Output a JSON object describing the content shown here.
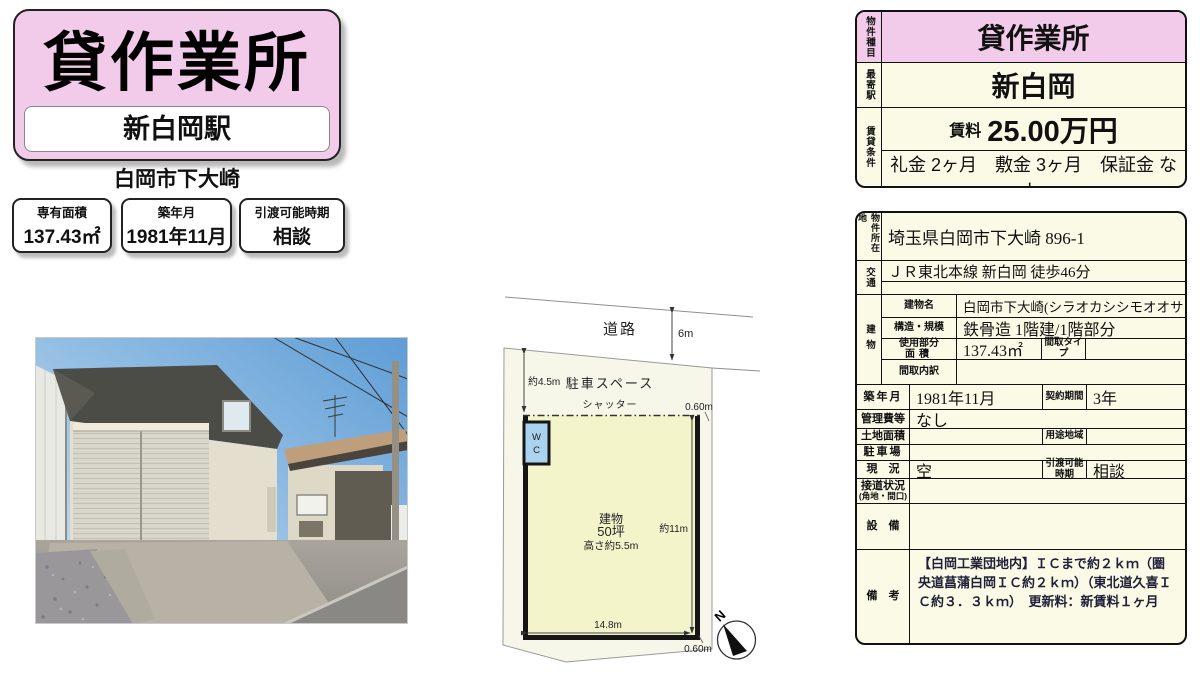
{
  "colors": {
    "pink": "#f3cbea",
    "cream": "#fafae6",
    "plan_parcel": "#f7f7e9",
    "plan_yellow": "#f4f4cb",
    "wc_blue": "#a9d3ef"
  },
  "header": {
    "title": "貸作業所",
    "station": "新白岡駅",
    "city": "白岡市下大崎",
    "badges": [
      {
        "label": "専有面積",
        "value": "137.43㎡"
      },
      {
        "label": "築年月",
        "value": "1981年11月"
      },
      {
        "label": "引渡可能時期",
        "value": "相談"
      }
    ]
  },
  "summary": {
    "type_label": "物件種目",
    "type_value": "貸作業所",
    "station_label": "最寄駅",
    "station_value": "新白岡",
    "terms_label": "賃貸条件",
    "rent_label": "賃料",
    "rent_value": "25.00万円",
    "terms_value": "礼金 2ヶ月　敷金 3ヶ月　保証金 なし"
  },
  "detail": {
    "address_label": "物件所在地",
    "address": "埼玉県白岡市下大崎 896-1",
    "access_label": "交通",
    "access": "ＪＲ東北本線 新白岡 徒歩46分",
    "building_label": "建物",
    "building_name_label": "建物名",
    "building_name": "白岡市下大崎(シラオカシシモオオサキ)",
    "structure_label": "構造・規模",
    "structure": "鉄骨造 1階建/1階部分",
    "area_label_1": "使用部分",
    "area_label_2": "面積",
    "area": "137.43㎡",
    "layout_type_label": "間取タイプ",
    "layout_type": "",
    "layout_detail_label": "間取内訳",
    "layout_detail": "",
    "built_label": "築年月",
    "built": "1981年11月",
    "contract_label": "契約期間",
    "contract": "3年",
    "management_label": "管理費等",
    "management": "なし",
    "land_label": "土地面積",
    "land": "",
    "zoning_label": "用途地域",
    "zoning": "",
    "parking_label": "駐車場",
    "parking": "",
    "status_label": "現　況",
    "status": "空",
    "handover_label_1": "引渡可能",
    "handover_label_2": "時期",
    "handover": "相談",
    "road_label_1": "接道状況",
    "road_label_2": "(角地・間口)",
    "road_value": "",
    "equipment_label": "設　備",
    "equipment": "",
    "remarks_label": "備　考",
    "remarks": "【白岡工業団地内】ＩＣまで約２ｋｍ（圏央道菖蒲白岡ＩＣ約２ｋｍ）（東北道久喜ＩＣ約３．３ｋｍ）　更新料：新賃料１ヶ月"
  },
  "plan": {
    "road": "道路",
    "road_width": "6m",
    "parking": "駐車スペース",
    "parking_depth": "約4.5m",
    "shutter": "シャッター",
    "gap_top": "0.60m",
    "gap_bottom": "0.60m",
    "building_line1": "建物",
    "building_line2": "50坪",
    "building_line3": "高さ約5.5m",
    "side_length": "約11m",
    "front_length": "14.8m",
    "wc_line1": "W",
    "wc_line2": "C",
    "north": "N"
  }
}
